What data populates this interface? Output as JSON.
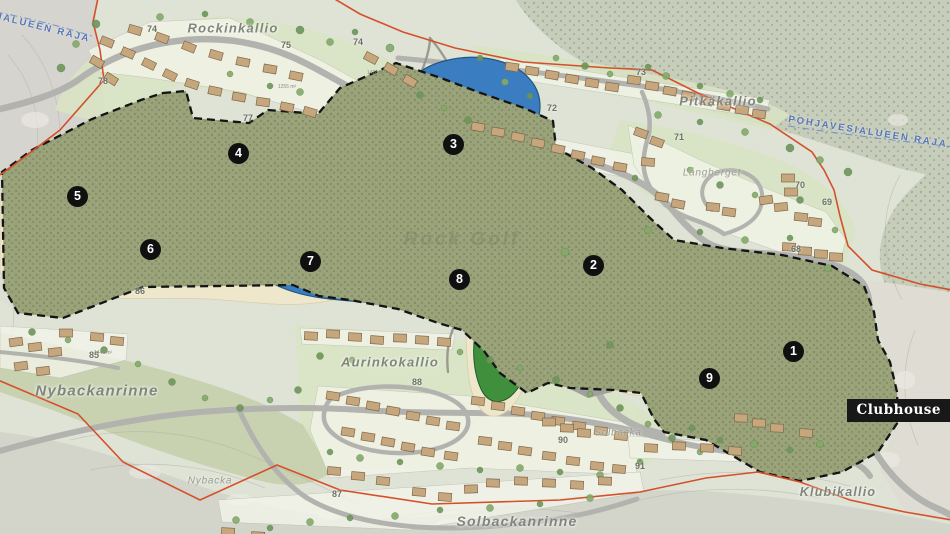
{
  "map": {
    "region_labels": {
      "rockinkallio": "Rockinkallio",
      "pitkakallio": "Pitkäkallio",
      "nybackanrinne": "Nybackanrinne",
      "aurinkokallio": "Aurinkokallio",
      "solbackanrinne": "Solbackanrinne",
      "klubikallio": "Klubikallio",
      "langberget": "Långberget",
      "solbacka": "Solbacka",
      "nybacka": "Nybacka"
    },
    "groundwater_boundary_label": "POHJAVESIALUEEN RAJA",
    "watermark": "Rock Golf",
    "clubhouse_label": "Clubhouse",
    "holes": [
      {
        "number": "1"
      },
      {
        "number": "2"
      },
      {
        "number": "3"
      },
      {
        "number": "4"
      },
      {
        "number": "5"
      },
      {
        "number": "6"
      },
      {
        "number": "7"
      },
      {
        "number": "8"
      },
      {
        "number": "9"
      }
    ],
    "parcel_numbers": [
      "74",
      "75",
      "74",
      "77",
      "78",
      "73",
      "72",
      "71",
      "70",
      "69",
      "68",
      "86",
      "85",
      "88",
      "87",
      "90",
      "91"
    ],
    "area_labels": [
      "1428 m²",
      "1255 m²",
      "1444 m²"
    ],
    "colors": {
      "water": "#3a7dc0",
      "fairway": "#3f8f3c",
      "green_light": "#a9d23f",
      "rough": "#99a278",
      "sand": "#efe7cc",
      "boundary_red": "#d4502a",
      "course_boundary_black": "#141414",
      "building_red": "#8a2e1d",
      "road_gray": "#b2b2ae",
      "label_gray": "#80867a",
      "water_label_blue": "#5577b8"
    }
  }
}
